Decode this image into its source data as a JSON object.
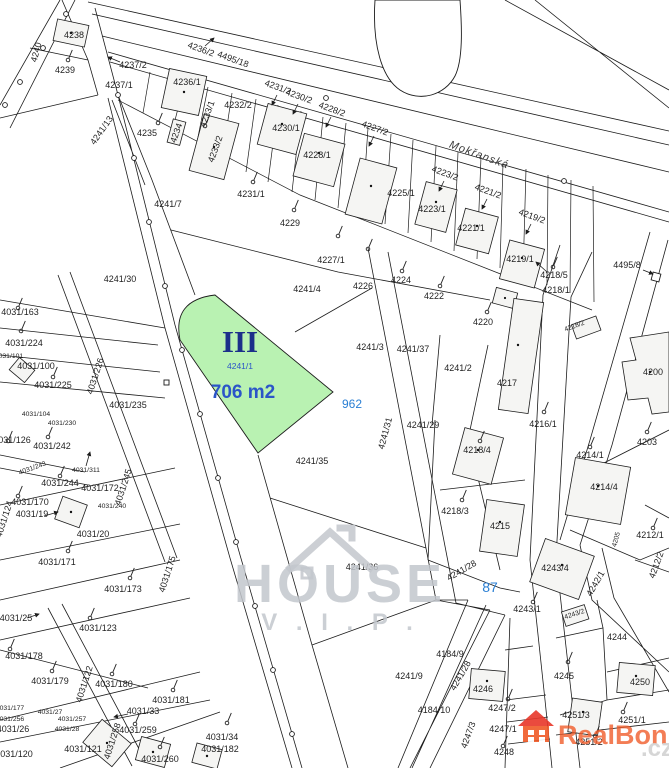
{
  "map": {
    "street_name": "Mokřanská",
    "highlight": {
      "roman": "III",
      "parcel": "4241/1",
      "area": "706 m2"
    },
    "blue_refs": {
      "ref1": "962",
      "ref2": "87"
    },
    "colors": {
      "highlight_fill": "#b9f2b2",
      "parcel_line": "#1c1c1c",
      "roman_text": "#1b2f8a",
      "area_text": "#2b55c8",
      "blue_ref": "#2a7fd4",
      "watermark_gray": "#c3c7cd",
      "brand_orange": "#f05a28"
    },
    "labels": [
      {
        "t": "4240",
        "x": 39,
        "y": 53,
        "r": -75
      },
      {
        "t": "4238",
        "x": 74,
        "y": 38
      },
      {
        "t": "4239",
        "x": 65,
        "y": 73
      },
      {
        "t": "4237/2",
        "x": 133,
        "y": 68
      },
      {
        "t": "4237/1",
        "x": 119,
        "y": 88
      },
      {
        "t": "4236/2",
        "x": 200,
        "y": 52,
        "r": 20
      },
      {
        "t": "4236/1",
        "x": 187,
        "y": 85
      },
      {
        "t": "4495/18",
        "x": 232,
        "y": 62,
        "r": 20
      },
      {
        "t": "4235",
        "x": 147,
        "y": 136
      },
      {
        "t": "4234",
        "x": 179,
        "y": 134,
        "r": -70
      },
      {
        "t": "4233/1",
        "x": 210,
        "y": 115,
        "r": -70
      },
      {
        "t": "4233/2",
        "x": 218,
        "y": 150,
        "r": -70
      },
      {
        "t": "4232/2",
        "x": 238,
        "y": 108
      },
      {
        "t": "4241/13",
        "x": 104,
        "y": 132,
        "r": -55
      },
      {
        "t": "4231/2",
        "x": 277,
        "y": 90,
        "r": 20
      },
      {
        "t": "4230/2",
        "x": 298,
        "y": 99,
        "r": 20
      },
      {
        "t": "4228/2",
        "x": 331,
        "y": 112,
        "r": 20
      },
      {
        "t": "4227/2",
        "x": 374,
        "y": 131,
        "r": 20
      },
      {
        "t": "4230/1",
        "x": 286,
        "y": 131
      },
      {
        "t": "4228/1",
        "x": 317,
        "y": 158
      },
      {
        "t": "4231/1",
        "x": 251,
        "y": 197
      },
      {
        "t": "4229",
        "x": 290,
        "y": 226
      },
      {
        "t": "4227/1",
        "x": 331,
        "y": 263
      },
      {
        "t": "4226",
        "x": 363,
        "y": 289
      },
      {
        "t": "4225/1",
        "x": 401,
        "y": 196
      },
      {
        "t": "4223/1",
        "x": 432,
        "y": 212
      },
      {
        "t": "4223/2",
        "x": 444,
        "y": 176,
        "r": 20
      },
      {
        "t": "4221/2",
        "x": 487,
        "y": 194,
        "r": 20
      },
      {
        "t": "4221/1",
        "x": 471,
        "y": 231
      },
      {
        "t": "4219/2",
        "x": 531,
        "y": 219,
        "r": 20
      },
      {
        "t": "4219/1",
        "x": 520,
        "y": 262
      },
      {
        "t": "4495/8",
        "x": 627,
        "y": 268
      },
      {
        "t": "4224",
        "x": 401,
        "y": 283
      },
      {
        "t": "4222",
        "x": 434,
        "y": 299
      },
      {
        "t": "4220",
        "x": 483,
        "y": 325
      },
      {
        "t": "4218/5",
        "x": 554,
        "y": 278
      },
      {
        "t": "4218/1",
        "x": 556,
        "y": 293
      },
      {
        "t": "4218/2",
        "x": 575,
        "y": 328,
        "r": -20,
        "c": "t"
      },
      {
        "t": "4241/7",
        "x": 168,
        "y": 207
      },
      {
        "t": "4241/30",
        "x": 120,
        "y": 282
      },
      {
        "t": "4241/4",
        "x": 307,
        "y": 292
      },
      {
        "t": "4241/3",
        "x": 370,
        "y": 350
      },
      {
        "t": "4241/37",
        "x": 413,
        "y": 352
      },
      {
        "t": "4241/2",
        "x": 458,
        "y": 371
      },
      {
        "t": "4217",
        "x": 507,
        "y": 386
      },
      {
        "t": "4241/29",
        "x": 423,
        "y": 428
      },
      {
        "t": "4216/1",
        "x": 543,
        "y": 427
      },
      {
        "t": "4200",
        "x": 653,
        "y": 375
      },
      {
        "t": "4203",
        "x": 647,
        "y": 445
      },
      {
        "t": "4241/31",
        "x": 388,
        "y": 434,
        "r": -75
      },
      {
        "t": "4241/35",
        "x": 312,
        "y": 464
      },
      {
        "t": "4218/4",
        "x": 477,
        "y": 453
      },
      {
        "t": "4218/3",
        "x": 455,
        "y": 514
      },
      {
        "t": "4215",
        "x": 500,
        "y": 529
      },
      {
        "t": "4214/1",
        "x": 590,
        "y": 458
      },
      {
        "t": "4214/4",
        "x": 604,
        "y": 490
      },
      {
        "t": "4212/1",
        "x": 650,
        "y": 538
      },
      {
        "t": "4212/2",
        "x": 659,
        "y": 566,
        "r": -70
      },
      {
        "t": "4205",
        "x": 618,
        "y": 540,
        "r": -75,
        "c": "t"
      },
      {
        "t": "4241/36",
        "x": 362,
        "y": 570
      },
      {
        "t": "4241/28",
        "x": 463,
        "y": 573,
        "r": -30
      },
      {
        "t": "4243/4",
        "x": 555,
        "y": 571
      },
      {
        "t": "4242/1",
        "x": 598,
        "y": 585,
        "r": -60
      },
      {
        "t": "4243/1",
        "x": 527,
        "y": 612
      },
      {
        "t": "4243/2",
        "x": 575,
        "y": 616,
        "r": -18,
        "c": "t"
      },
      {
        "t": "4244",
        "x": 617,
        "y": 640
      },
      {
        "t": "4245",
        "x": 564,
        "y": 679
      },
      {
        "t": "4250",
        "x": 640,
        "y": 685
      },
      {
        "t": "4251/1",
        "x": 632,
        "y": 723
      },
      {
        "t": "4251/3",
        "x": 576,
        "y": 718
      },
      {
        "t": "4251/2",
        "x": 589,
        "y": 745
      },
      {
        "t": "4246",
        "x": 483,
        "y": 692
      },
      {
        "t": "4247/2",
        "x": 502,
        "y": 711
      },
      {
        "t": "4247/1",
        "x": 503,
        "y": 732
      },
      {
        "t": "4247/3",
        "x": 471,
        "y": 736,
        "r": -70
      },
      {
        "t": "4248",
        "x": 504,
        "y": 755
      },
      {
        "t": "4184/9",
        "x": 450,
        "y": 657
      },
      {
        "t": "4184/10",
        "x": 434,
        "y": 713
      },
      {
        "t": "4241/9",
        "x": 409,
        "y": 679
      },
      {
        "t": "4241/28",
        "x": 463,
        "y": 677,
        "r": -60
      },
      {
        "t": "4031/163",
        "x": 20,
        "y": 315
      },
      {
        "t": "4031/224",
        "x": 24,
        "y": 346
      },
      {
        "t": "4031/101",
        "x": 9,
        "y": 358,
        "c": "t"
      },
      {
        "t": "4031/100",
        "x": 36,
        "y": 369
      },
      {
        "t": "4031/225",
        "x": 53,
        "y": 388
      },
      {
        "t": "4031/226",
        "x": 98,
        "y": 377,
        "r": -72
      },
      {
        "t": "4031/104",
        "x": 36,
        "y": 416,
        "c": "t"
      },
      {
        "t": "4031/230",
        "x": 62,
        "y": 425,
        "c": "t"
      },
      {
        "t": "4031/235",
        "x": 128,
        "y": 408
      },
      {
        "t": "4031/126",
        "x": 12,
        "y": 443
      },
      {
        "t": "4031/242",
        "x": 52,
        "y": 449
      },
      {
        "t": "4031/243",
        "x": 33,
        "y": 470,
        "r": -20,
        "c": "t"
      },
      {
        "t": "4031/311",
        "x": 86,
        "y": 472,
        "c": "t"
      },
      {
        "t": "4031/244",
        "x": 60,
        "y": 486
      },
      {
        "t": "4031/172",
        "x": 100,
        "y": 491
      },
      {
        "t": "4031/245",
        "x": 126,
        "y": 488,
        "r": -72
      },
      {
        "t": "4031/170",
        "x": 30,
        "y": 505
      },
      {
        "t": "4031/19",
        "x": 32,
        "y": 517
      },
      {
        "t": "4031/240",
        "x": 112,
        "y": 508,
        "c": "t"
      },
      {
        "t": "4031/20",
        "x": 93,
        "y": 537
      },
      {
        "t": "4031/171",
        "x": 57,
        "y": 565
      },
      {
        "t": "4031/124",
        "x": 7,
        "y": 520,
        "r": -72
      },
      {
        "t": "4031/173",
        "x": 123,
        "y": 592
      },
      {
        "t": "4031/175",
        "x": 170,
        "y": 575,
        "r": -72
      },
      {
        "t": "4031/25",
        "x": 16,
        "y": 621
      },
      {
        "t": "4031/123",
        "x": 98,
        "y": 631
      },
      {
        "t": "4031/178",
        "x": 24,
        "y": 659
      },
      {
        "t": "4031/179",
        "x": 50,
        "y": 684
      },
      {
        "t": "4031/122",
        "x": 87,
        "y": 685,
        "r": -72
      },
      {
        "t": "4031/180",
        "x": 114,
        "y": 687
      },
      {
        "t": "4031/181",
        "x": 171,
        "y": 703
      },
      {
        "t": "4031/177",
        "x": 10,
        "y": 710,
        "c": "t"
      },
      {
        "t": "4031/256",
        "x": 10,
        "y": 721,
        "c": "t"
      },
      {
        "t": "4031/26",
        "x": 13,
        "y": 732
      },
      {
        "t": "4031/33",
        "x": 143,
        "y": 714
      },
      {
        "t": "4031/259",
        "x": 138,
        "y": 733
      },
      {
        "t": "4031/258",
        "x": 115,
        "y": 742,
        "r": -72
      },
      {
        "t": "4031/121",
        "x": 83,
        "y": 752
      },
      {
        "t": "4031/120",
        "x": 14,
        "y": 757
      },
      {
        "t": "4031/260",
        "x": 160,
        "y": 762
      },
      {
        "t": "4031/27",
        "x": 50,
        "y": 714,
        "c": "t"
      },
      {
        "t": "4031/257",
        "x": 72,
        "y": 721,
        "c": "t"
      },
      {
        "t": "4031/28",
        "x": 67,
        "y": 731,
        "c": "t"
      },
      {
        "t": "4031/34",
        "x": 222,
        "y": 740
      },
      {
        "t": "4031/182",
        "x": 220,
        "y": 752
      }
    ],
    "symbols": [
      [
        68,
        60
      ],
      [
        158,
        123
      ],
      [
        205,
        126
      ],
      [
        253,
        182
      ],
      [
        294,
        210
      ],
      [
        338,
        236
      ],
      [
        368,
        249
      ],
      [
        402,
        271
      ],
      [
        440,
        286
      ],
      [
        487,
        312
      ],
      [
        553,
        267
      ],
      [
        544,
        412
      ],
      [
        647,
        432
      ],
      [
        462,
        500
      ],
      [
        480,
        441
      ],
      [
        590,
        447
      ],
      [
        653,
        528
      ],
      [
        533,
        602
      ],
      [
        568,
        662
      ],
      [
        623,
        712
      ],
      [
        595,
        736
      ],
      [
        508,
        699
      ],
      [
        503,
        746
      ],
      [
        18,
        308
      ],
      [
        21,
        331
      ],
      [
        53,
        377
      ],
      [
        8,
        441
      ],
      [
        48,
        437
      ],
      [
        60,
        476
      ],
      [
        18,
        496
      ],
      [
        68,
        551
      ],
      [
        130,
        578
      ],
      [
        90,
        618
      ],
      [
        10,
        649
      ],
      [
        52,
        671
      ],
      [
        112,
        674
      ],
      [
        173,
        690
      ],
      [
        135,
        724
      ],
      [
        160,
        747
      ],
      [
        227,
        723
      ]
    ]
  },
  "watermarks": {
    "house": {
      "line1": "HOUSE",
      "line2": "V . I . P ."
    },
    "realbonus": {
      "brand": "RealBonus",
      "tld": ".cz"
    }
  }
}
